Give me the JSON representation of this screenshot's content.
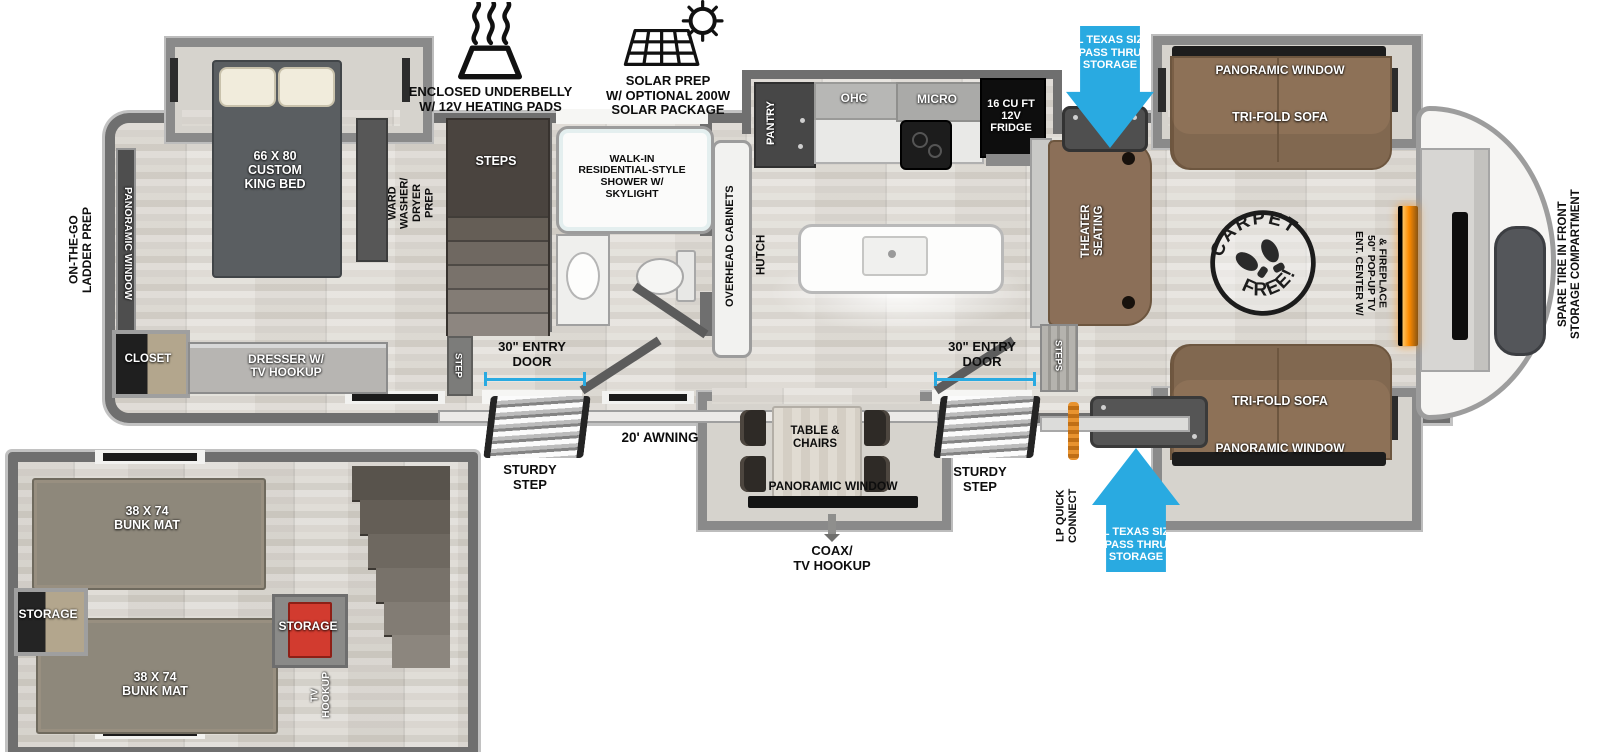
{
  "legend": {
    "underbelly": "ENCLOSED UNDERBELLY\nW/ 12V HEATING PADS",
    "solar": "SOLAR PREP\nW/ OPTIONAL 200W\nSOLAR PACKAGE"
  },
  "storage_arrows": {
    "top": "XL TEXAS SIZE\nPASS THRU\nSTORAGE",
    "bottom": "XL TEXAS SIZE\nPASS THRU\nSTORAGE"
  },
  "bedroom": {
    "bed": "66 X  80\nCUSTOM\nKING BED",
    "window": "PANORAMIC WINDOW",
    "ladder": "ON-THE-GO\nLADDER PREP",
    "ward": "WARD\nWASHER/\nDRYER\nPREP",
    "closet": "CLOSET",
    "dresser": "DRESSER W/\nTV HOOKUP"
  },
  "bath": {
    "shower": "WALK-IN\nRESIDENTIAL-STYLE\nSHOWER W/\nSKYLIGHT",
    "steps": "STEPS",
    "step": "STEP"
  },
  "kitchen": {
    "pantry": "PANTRY",
    "ohc": "OHC",
    "micro": "MICRO",
    "fridge": "16 CU FT\n12V\nFRIDGE",
    "overhead": "OVERHEAD CABINETS",
    "hutch": "HUTCH"
  },
  "living": {
    "theater": "THEATER\nSEATING",
    "steps": "STEPS",
    "sofa_top": "TRI-FOLD SOFA",
    "window_top": "PANORAMIC WINDOW",
    "sofa_bottom": "TRI-FOLD SOFA",
    "window_bottom": "PANORAMIC WINDOW",
    "carpet_top": "CARPET",
    "carpet_bottom": "FREE!",
    "ent_center": "ENT. CENTER W/\n50\" POP-UP TV\n& FIREPLACE"
  },
  "front": {
    "spare_tire": "SPARE TIRE IN FRONT\nSTORAGE COMPARTMENT"
  },
  "exterior": {
    "door_rear": "30\" ENTRY\nDOOR",
    "door_front": "30\" ENTRY\nDOOR",
    "sturdy_rear": "STURDY\nSTEP",
    "sturdy_front": "STURDY\nSTEP",
    "awning": "20' AWNING",
    "coax": "COAX/\nTV HOOKUP",
    "lp": "LP QUICK\nCONNECT"
  },
  "dinette": {
    "table": "TABLE &\nCHAIRS",
    "window": "PANORAMIC WINDOW"
  },
  "bunkroom": {
    "bunk_top": "38 X 74\nBUNK MAT",
    "bunk_bottom": "38 X 74\nBUNK MAT",
    "storage_left": "STORAGE",
    "storage_right": "STORAGE",
    "tv": "TV\nHOOKUP"
  },
  "colors": {
    "arrow_blue": "#29aae1",
    "wall_gray": "#6f6f6f",
    "sofa_brown": "#8d7157",
    "fireplace_orange": "#ff8c00",
    "bunk_item_red": "#d23b2f",
    "floor_light": "#e2dfda"
  }
}
